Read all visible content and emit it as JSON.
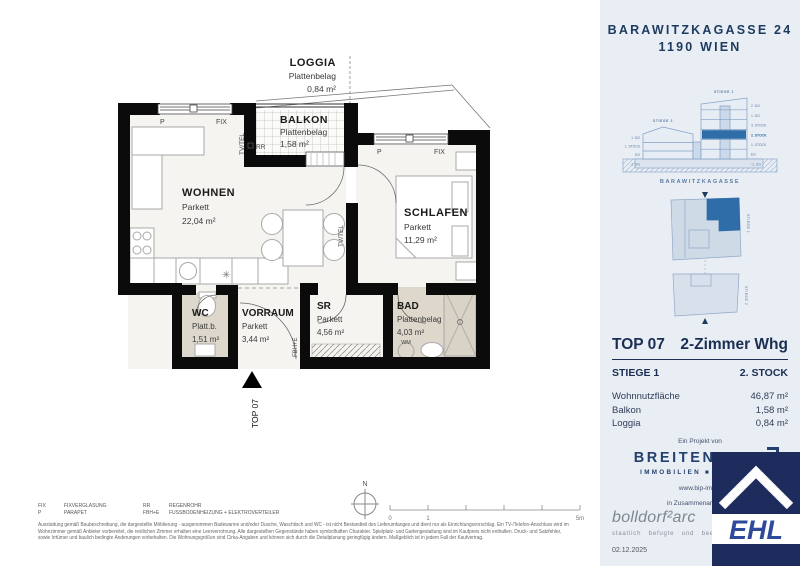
{
  "header": {
    "line1": "BARAWITZKAGASSE 24",
    "line2": "1190 WIEN"
  },
  "section": {
    "stiege1": "STIEGE 1",
    "stiege2": "STIEGE 2",
    "left_floors": [
      "1. DG",
      "1. STOCK",
      "EG",
      "-1. UG"
    ],
    "right_floors": [
      "2. DG",
      "1. DG",
      "3. STOCK",
      "2. STOCK",
      "1. STOCK",
      "EG",
      "-1. UG"
    ],
    "street": "BARAWITZKAGASSE"
  },
  "siteplan": {
    "stiege1": "STIEGE 1",
    "stiege2": "STIEGE 2"
  },
  "unit": {
    "top": "TOP 07",
    "type": "2-Zimmer Whg",
    "stiege": "STIEGE 1",
    "stock": "2. STOCK",
    "rows": [
      {
        "label": "Wohnnutzfläche",
        "value": "46,87 m²"
      },
      {
        "label": "Balkon",
        "value": "1,58 m²"
      },
      {
        "label": "Loggia",
        "value": "0,84 m²"
      }
    ]
  },
  "plan": {
    "rooms": {
      "loggia": {
        "name": "LOGGIA",
        "floor": "Plattenbelag",
        "area": "0,84 m²"
      },
      "balkon": {
        "name": "BALKON",
        "floor": "Plattenbelag",
        "area": "1,58 m²"
      },
      "wohnen": {
        "name": "WOHNEN",
        "floor": "Parkett",
        "area": "22,04 m²"
      },
      "schlafen": {
        "name": "SCHLAFEN",
        "floor": "Parkett",
        "area": "11,29 m²"
      },
      "wc": {
        "name": "WC",
        "floor": "Platt.b.",
        "area": "1,51 m²"
      },
      "vorraum": {
        "name": "VORRAUM",
        "floor": "Parkett",
        "area": "3,44 m²"
      },
      "sr": {
        "name": "SR",
        "floor": "Parkett",
        "area": "4,56 m²"
      },
      "bad": {
        "name": "BAD",
        "floor": "Plattenbelag",
        "area": "4,03 m²"
      }
    },
    "labels": {
      "p": "P",
      "fix": "FIX",
      "rr": "RR",
      "tvtel": "TV/TEL",
      "fbhe": "FBH+E",
      "wm": "WM",
      "top_marker": "TOP 07",
      "fixture_symbol": "✳"
    }
  },
  "legend": {
    "items": [
      {
        "abbr": "FIX",
        "text": "FIXVERGLASUNG"
      },
      {
        "abbr": "P",
        "text": "PARAPET"
      },
      {
        "abbr": "RR",
        "text": "REGENROHR"
      },
      {
        "abbr": "FBH+E",
        "text": "FUSSBODENHEIZUNG + ELEKTROVERTEILER"
      }
    ]
  },
  "disclaimer": {
    "line1": "Ausstattung gemäß Baubeschreibung, die dargestellte Möblierung - ausgenommen Badewanne und/oder Dusche, Waschtisch und WC - ist nicht Bestandteil des Lieferumfanges und dient nur als Einrichtungsvorschlag. Ein TV-/Telefon-Anschluss wird im",
    "line2": "Wohnzimmer gemäß Anbieter vorbereitet, die restlichen Zimmer erhalten eine Leerverrohrung. Alle dargestellten Gegenstände haben symbolhaften Charakter. Spielplatz- und Gartengestaltung sind im Kaufpreis nicht enthalten. Druck- und Satzfehler,",
    "line3": "sowie Irrtümer und baulich bedingte Änderungen vorbehalten. Die Wohnungsgrößen sind Cirka-Angaben und können sich durch die Detailplanung geringfügig ändern. Maßgeblich ist in jedem Fall der Kaufvertrag."
  },
  "scalebar": {
    "north": "N",
    "t0": "0",
    "t1": "1",
    "t5": "5m"
  },
  "footer": {
    "project_by": "Ein Projekt von",
    "brand": "BREITENEDER",
    "brand_sub": "IMMOBILIEN ■ PARKING",
    "website": "www.bip-immo",
    "coop": "in Zusammenarbeit mit",
    "partner": "bolldorf²arc",
    "partner_sub": "staatlich befugte und bee",
    "date": "02.12.2025",
    "ehl": "EHL"
  }
}
